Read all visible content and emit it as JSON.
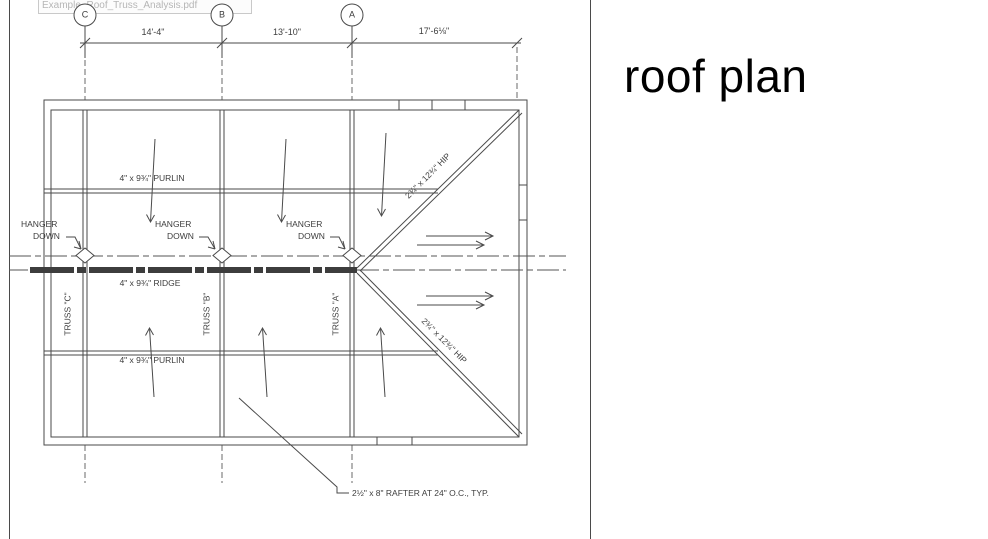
{
  "tooltip": {
    "filename": "Example_Roof_Truss_Analysis.pdf"
  },
  "sheet": {
    "title": "roof plan"
  },
  "grid": {
    "bubbles": [
      "C",
      "B",
      "A"
    ],
    "dimensions": [
      "14'-4\"",
      "13'-10\"",
      "17'-6⅛\""
    ]
  },
  "members": {
    "purlin_top": "4\" x 9¾\" PURLIN",
    "purlin_bottom": "4\" x 9¾\" PURLIN",
    "ridge": "4\" x 9¾\" RIDGE",
    "hip_upper": "2¾\" x 12¾\" HIP",
    "hip_lower": "2¾\" x 12¾\" HIP",
    "rafter_note": "2½\" x 8\" RAFTER AT 24\" O.C., TYP."
  },
  "hangers": [
    {
      "line1": "HANGER",
      "line2": "DOWN"
    },
    {
      "line1": "HANGER",
      "line2": "DOWN"
    },
    {
      "line1": "HANGER",
      "line2": "DOWN"
    }
  ],
  "trusses": [
    "TRUSS \"C\"",
    "TRUSS \"B\"",
    "TRUSS \"A\""
  ]
}
